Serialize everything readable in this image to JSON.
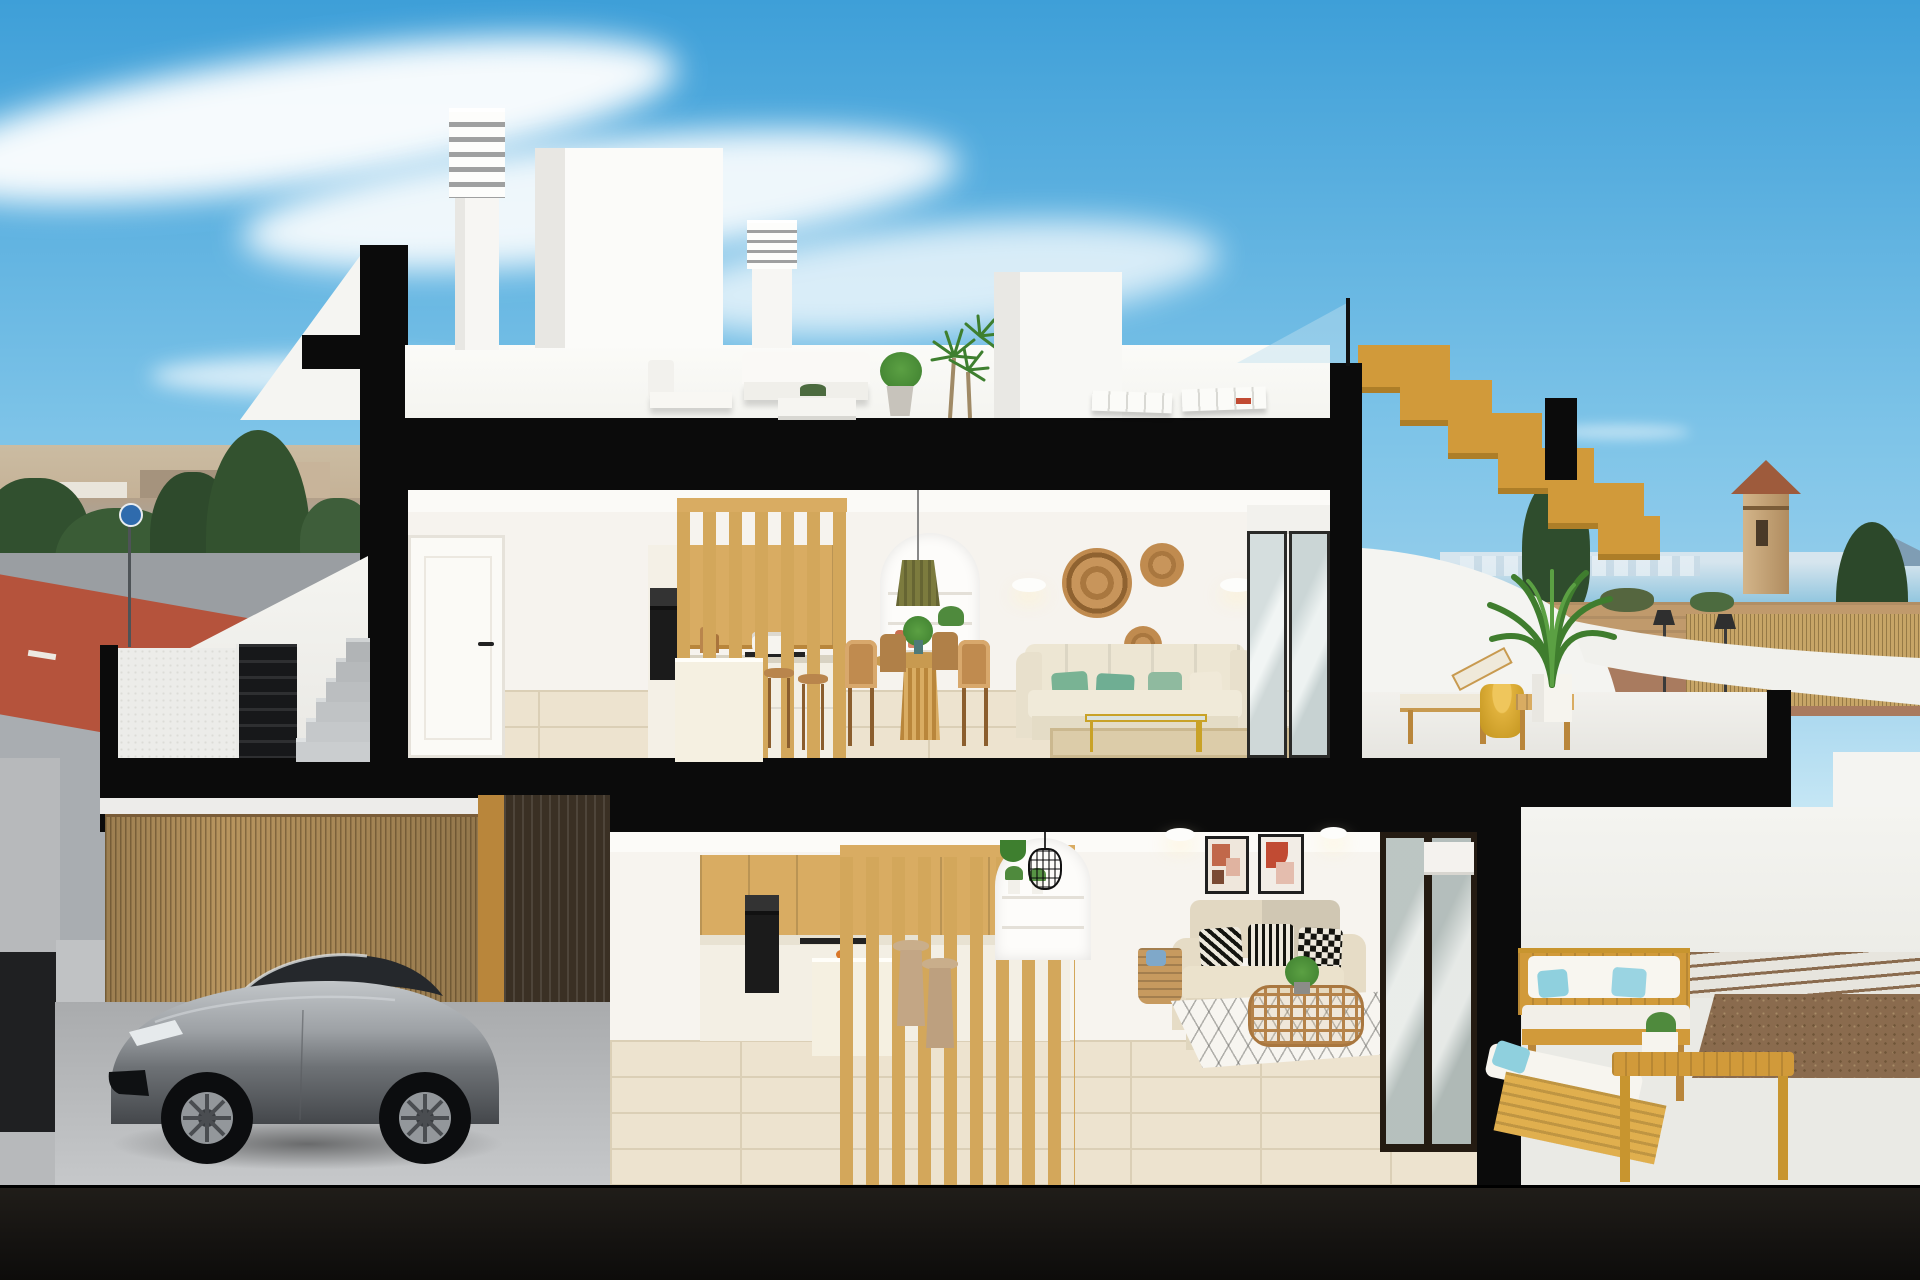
{
  "image_kind": "architectural-cutaway-render",
  "visible_text": [],
  "palette": {
    "sky_top": "#3E9FD8",
    "sky_mid": "#7EC4E8",
    "sky_low": "#C8E8F5",
    "cut": "#0B0B0B",
    "ground": "#16130F",
    "white_wall": "#F7F6F3",
    "white_shade": "#E8E7E3",
    "deck": "#F4F4F0",
    "wood": "#D9AC62",
    "wood_dark": "#B9863B",
    "stair_wood": "#D19A3A",
    "stair_wood_dark": "#AD7E28",
    "slat": "#D3A75B",
    "dark_slat": "#3A3024",
    "tile": "#EDE3CF",
    "tile_line": "#DBCFB6",
    "counter": "#F3EFE4",
    "appliance": "#1B1B1B",
    "cream_sofa": "#EDE6D3",
    "green_pillow": "#79B394",
    "teal_pillow": "#6FAE93",
    "rattan": "#C08B4F",
    "rattan_dark": "#A9773F",
    "bamboo": "#B8955F",
    "bamboo_line": "#8A6B44",
    "car_hi": "#C2C6C9",
    "car_mid": "#82868A",
    "car_lo": "#3C3F43",
    "glass": "#BEE1F0",
    "sea": "#85C0DC",
    "skyline": "#D6E5EE",
    "town": "#C4B095",
    "town_shade": "#A5937D",
    "tree": "#31502F",
    "tree_light": "#4C6B3F",
    "field": "#C09A6C",
    "red_lane": "#B5533C",
    "street": "#9A9EA2",
    "sidewalk": "#A9ADB1",
    "terracotta": "#C96F4F",
    "olive": "#7C7B3E",
    "blue_pillow": "#8FD0DE",
    "gravel": "#8A6B4E",
    "terrace_floor": "#EAEAE5",
    "beige_sofa": "#E2D8C2",
    "yellow": "#E0B13C",
    "reed": "#C7A567",
    "lamp": "#2F2F2F",
    "art_red": "#C14B33",
    "art_peach": "#E0B3A0",
    "glass_door": "#CBD6D6"
  },
  "scene": {
    "sky": [
      "clouds"
    ],
    "background_left": [
      "town-skyline",
      "trees",
      "road",
      "red-bike-lane",
      "round-sign"
    ],
    "background_right": [
      "sea",
      "distant-skyline",
      "watch-tower",
      "conifers",
      "dirt-field",
      "reed-fence",
      "street-lamps"
    ],
    "roof_level": [
      "louvered-chimney",
      "stair-bulkhead",
      "louvered-chimney",
      "outdoor-lounge-set",
      "potted-plants",
      "dracaena-plant",
      "flat-sun-loungers",
      "glass-railing",
      "wooden-roof-stair"
    ],
    "upper_floor": [
      "hall-door",
      "kitchen-cabinets",
      "oven-column",
      "wood-slat-screen",
      "kitchen-island",
      "bar-stools",
      "arched-niche",
      "olive-pendant-lamp",
      "round-dining-table",
      "rattan-chairs",
      "wall-sconces",
      "rattan-wall-decor",
      "cream-sofa",
      "green-pillows",
      "glass-coffee-table",
      "rug",
      "sliding-glass-door"
    ],
    "upper_terrace": [
      "sun-lounger",
      "yellow-side-table",
      "wood-bench",
      "potted-palm",
      "curved-parapet"
    ],
    "entry_level": [
      "stair-parapet",
      "textured-wall",
      "black-gate",
      "concrete-steps"
    ],
    "garage": [
      "bamboo-fence",
      "dark-slat-panel",
      "sports-car",
      "concrete-floor"
    ],
    "ground_floor": [
      "kitchen-cabinets",
      "oven",
      "wood-slat-screen",
      "kitchen-island",
      "stools",
      "glass-dining-table",
      "tan-chairs",
      "arched-niche",
      "wire-pendant-lamp",
      "wall-sconces",
      "framed-art",
      "beige-sofa",
      "patterned-pillows",
      "rattan-coffee-table",
      "diamond-rug",
      "basket",
      "sliding-glass-doors"
    ],
    "ground_terrace": [
      "wooden-outdoor-sofa",
      "white-cushions",
      "blue-pillows",
      "wooden-chaise",
      "wooden-bench-table",
      "planter",
      "paving-strips",
      "gravel-bed",
      "parapet-walls"
    ],
    "section": [
      "black-cut-slabs",
      "dark-ground-band"
    ]
  }
}
